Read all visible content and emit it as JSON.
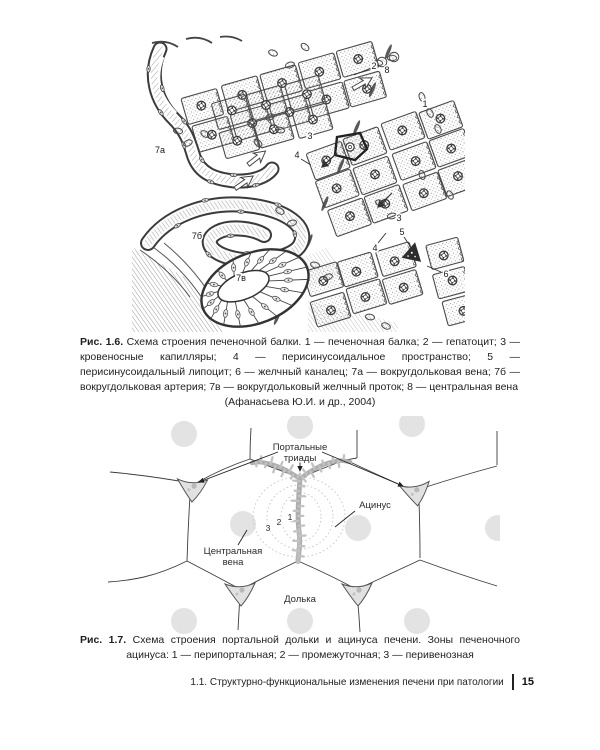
{
  "page": {
    "footer_text": "1.1. Структурно-функциональные изменения печени при патологии",
    "page_number": "15"
  },
  "fig16": {
    "caption_label": "Рис. 1.6.",
    "caption_text": "Схема строения печеночной балки. 1 — печеночная балка; 2 — гепатоцит; 3 — кровеносные капилляры; 4 — перисинусоидальное пространство; 5 — перисинусоидальный липоцит; 6 — желчный каналец; 7а — вокругдольковая вена; 7б — вокругдольковая артерия; 7в — вокругдольковый желчный проток; 8 — центральная вена",
    "caption_credit": "(Афанасьева Ю.И. и др., 2004)",
    "labels": {
      "l1": "1",
      "l2": "2",
      "l3": "3",
      "l3b": "3",
      "l4": "4",
      "l4b": "4",
      "l5": "5",
      "l6": "6",
      "l7a": "7а",
      "l7b": "7б",
      "l7v": "7в",
      "l8": "8"
    }
  },
  "fig17": {
    "caption_label": "Рис. 1.7.",
    "caption_text": "Схема строения портальной дольки и ацинуса печени. Зоны печеночного ацинуса: 1 — перипортальная; 2 — промежуточная; 3 — перивенозная",
    "labels": {
      "portal_triads_1": "Портальные",
      "portal_triads_2": "триады",
      "acinus": "Ацинус",
      "central_vein_1": "Центральная",
      "central_vein_2": "вена",
      "lobule": "Долька",
      "zone1": "1",
      "zone2": "2",
      "zone3": "3"
    }
  },
  "colors": {
    "ink": "#3a3a3a",
    "tree_gray": "#b0b0b0",
    "faded_circle": "#e3e3e3",
    "triad_fill": "#e1e1e1"
  }
}
